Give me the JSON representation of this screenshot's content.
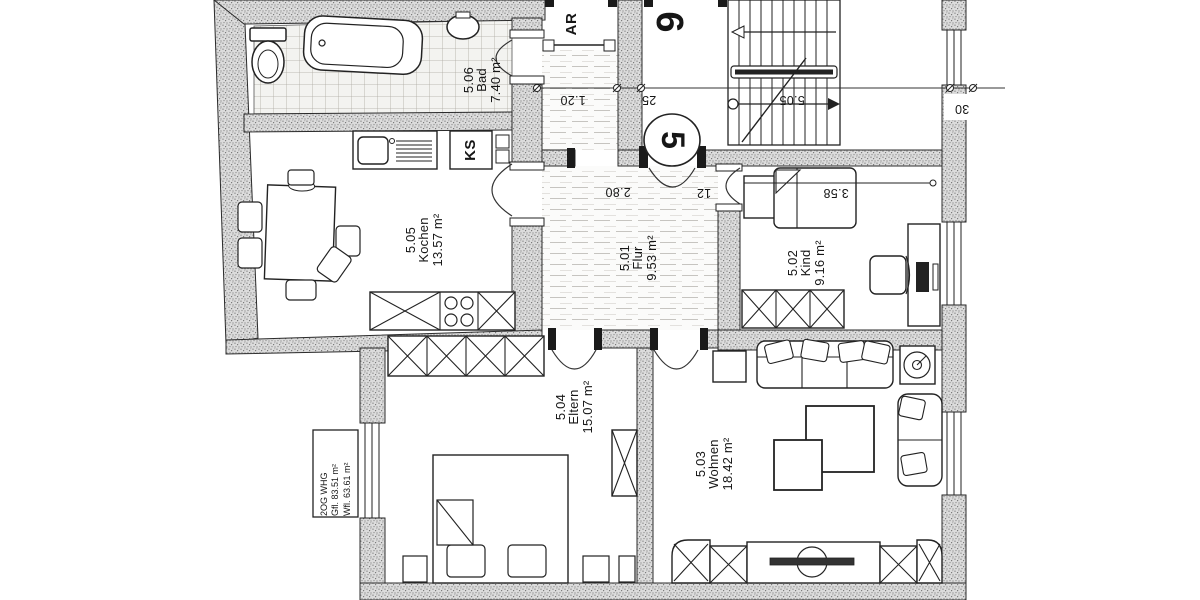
{
  "plan": {
    "info_box": {
      "floor": "2OG WHG",
      "gfl": "Gfl. 83.51 m²",
      "wfl": "Wfl. 63.61 m²"
    },
    "rooms": {
      "bad": {
        "number": "5.06",
        "name": "Bad",
        "area": "7.40 m²"
      },
      "kochen": {
        "number": "5.05",
        "name": "Kochen",
        "area": "13.57 m²"
      },
      "flur": {
        "number": "5.01",
        "name": "Flur",
        "area": "9.53 m²"
      },
      "kind": {
        "number": "5.02",
        "name": "Kind",
        "area": "9.16 m²"
      },
      "eltern": {
        "number": "5.04",
        "name": "Eltern",
        "area": "15.07 m²"
      },
      "wohnen": {
        "number": "5.03",
        "name": "Wohnen",
        "area": "18.42 m²"
      },
      "abstellraum": {
        "label": "AR"
      }
    },
    "markers": {
      "apartment_door": "5",
      "neighbor_door": "6",
      "fridge": "KS"
    },
    "dimensions": {
      "corridor_width": "1.20",
      "wall_thickness_25": "25",
      "flur_width": "2.80",
      "wall_thickness_12": "12",
      "kind_width": "3.58",
      "stair_width": "5.05",
      "wall_thickness_30": "30"
    }
  }
}
